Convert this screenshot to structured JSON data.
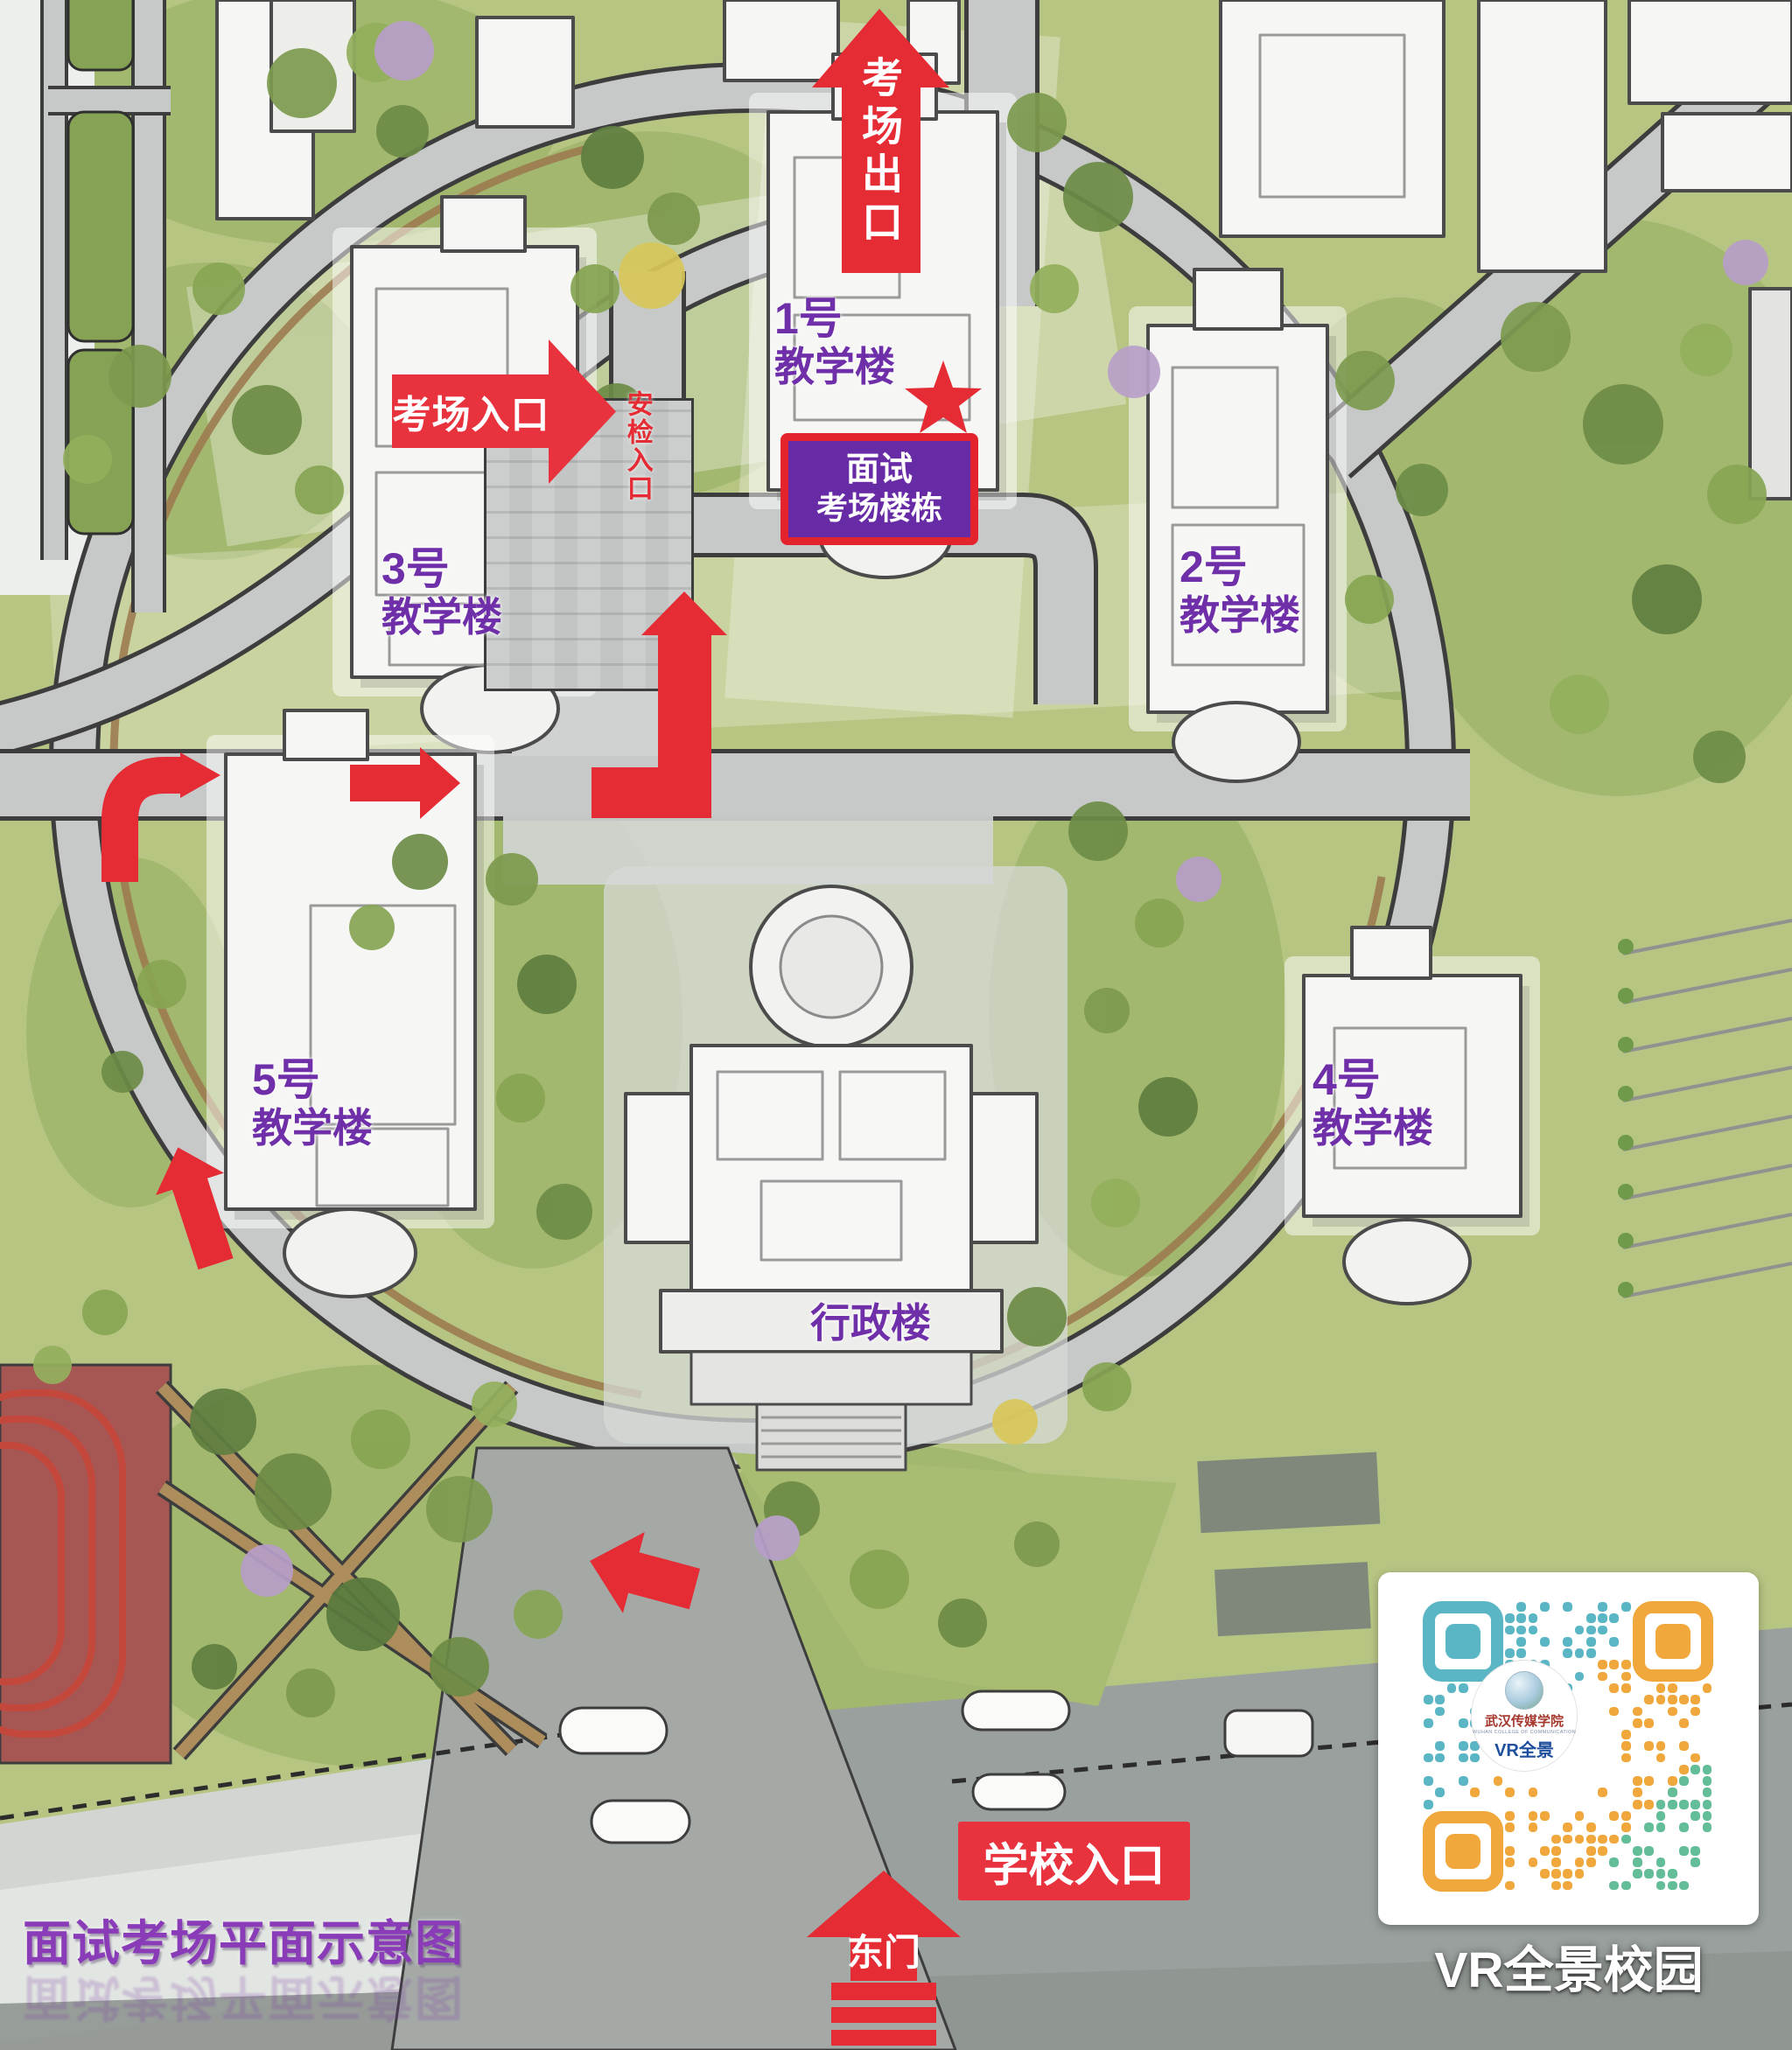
{
  "labels": {
    "title": "面试考场平面示意图",
    "exam_exit": "考场出口",
    "exam_entrance": "考场入口",
    "security_entrance": "安检入口",
    "interview_line1": "面试",
    "interview_line2": "考场楼栋",
    "admin": "行政楼",
    "school_entrance": "学校入口",
    "east_gate": "东门"
  },
  "buildings": {
    "b1": {
      "num": "1号",
      "name": "教学楼"
    },
    "b2": {
      "num": "2号",
      "name": "教学楼"
    },
    "b3": {
      "num": "3号",
      "name": "教学楼"
    },
    "b4": {
      "num": "4号",
      "name": "教学楼"
    },
    "b5": {
      "num": "5号",
      "name": "教学楼"
    }
  },
  "qr": {
    "caption": "VR全景校园",
    "logo_school": "武汉传媒学院",
    "logo_school_en": "WUHAN COLLEGE OF COMMUNICATION",
    "logo_vr": "VR全景",
    "colors": {
      "teal": "#5ab6c4",
      "orange": "#f0a73c",
      "green": "#62bd98"
    }
  },
  "colors": {
    "arrow_red": "#e52b34",
    "banner_red": "#e8333e",
    "label_purple": "#6f2fa8",
    "interview_purple": "#682ba6",
    "title_purple": "#8a3cb8",
    "lawn_green": "#b7c583",
    "road_gray": "#c6c9c8"
  }
}
